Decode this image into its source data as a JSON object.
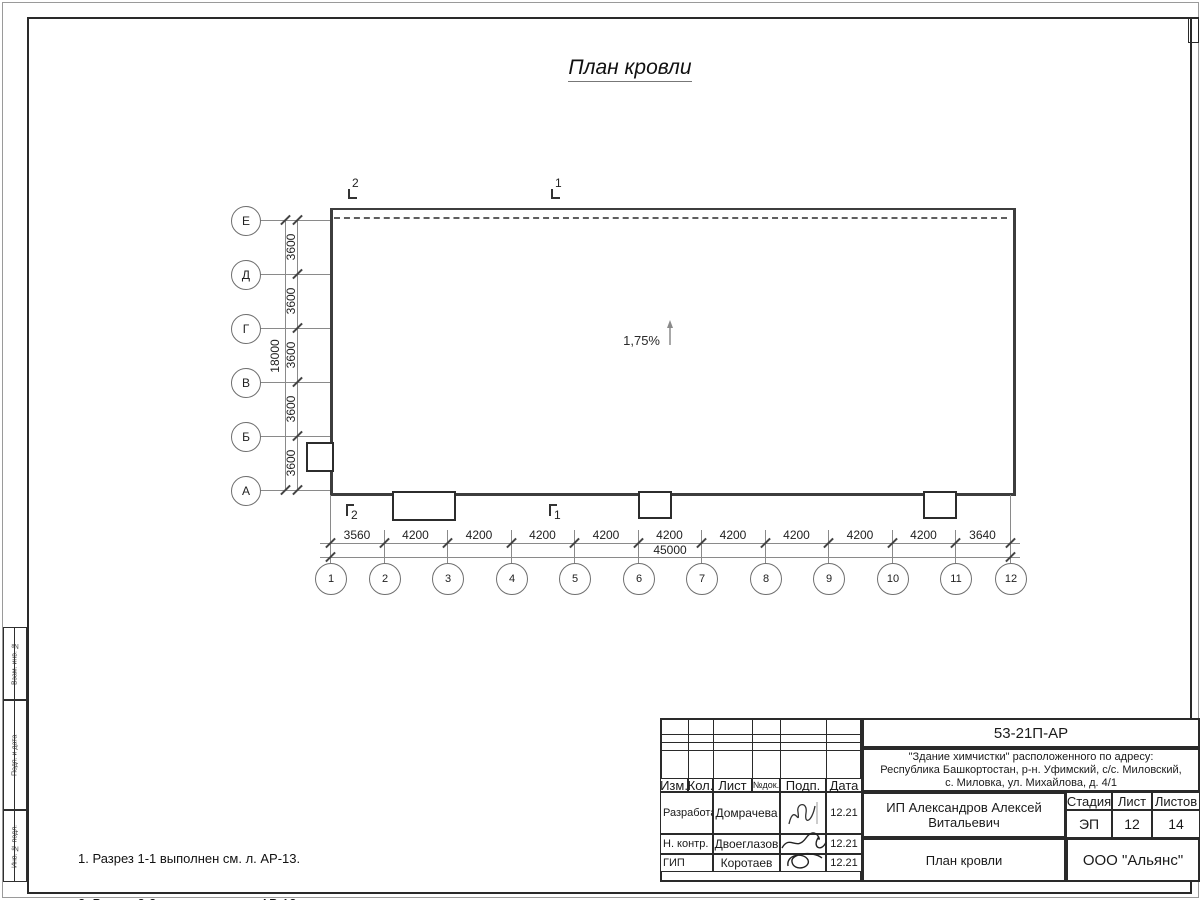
{
  "page": {
    "title": "План кровли"
  },
  "plan": {
    "slope_label": "1,75%",
    "row_axes": [
      "Е",
      "Д",
      "Г",
      "В",
      "Б",
      "А"
    ],
    "row_dims": [
      "3600",
      "3600",
      "3600",
      "3600",
      "3600"
    ],
    "row_total": "18000",
    "col_axes": [
      "1",
      "2",
      "3",
      "4",
      "5",
      "6",
      "7",
      "8",
      "9",
      "10",
      "11",
      "12"
    ],
    "col_dims": [
      "3560",
      "4200",
      "4200",
      "4200",
      "4200",
      "4200",
      "4200",
      "4200",
      "4200",
      "4200",
      "3640"
    ],
    "col_total": "45000",
    "section_marks": {
      "top": [
        "2",
        "1"
      ],
      "bottom": [
        "2",
        "1"
      ]
    }
  },
  "notes": [
    "1. Разрез 1-1 выполнен см. л. АР-13.",
    "2. Разрез 2-2 выполнен см. л. АР-13."
  ],
  "side_strip": [
    "Взам. инв. №",
    "Подп. и дата",
    "Инв. № подл."
  ],
  "titleblock": {
    "doc_number": "53-21П-АР",
    "object_line1": "\"Здание химчистки\" расположенного по адресу:",
    "object_line2": "Республика Башкортостан, р-н. Уфимский, с/с. Миловский,",
    "object_line3": "с. Миловка, ул. Михайлова, д. 4/1",
    "header_cells": [
      "Изм.",
      "Кол.",
      "Лист",
      "№док.",
      "Подп.",
      "Дата"
    ],
    "rows": [
      {
        "role": "Разработал",
        "name": "Домрачева",
        "date": "12.21"
      },
      {
        "role": "Н. контр.",
        "name": "Двоеглазов",
        "date": "12.21"
      },
      {
        "role": "ГИП",
        "name": "Коротаев",
        "date": "12.21"
      }
    ],
    "client": "ИП Александров Алексей Витальевич",
    "sheet_title": "План кровли",
    "stage_label": "Стадия",
    "sheet_label": "Лист",
    "sheets_label": "Листов",
    "stage": "ЭП",
    "sheet": "12",
    "sheets": "14",
    "company": "ООО \"Альянс\""
  }
}
